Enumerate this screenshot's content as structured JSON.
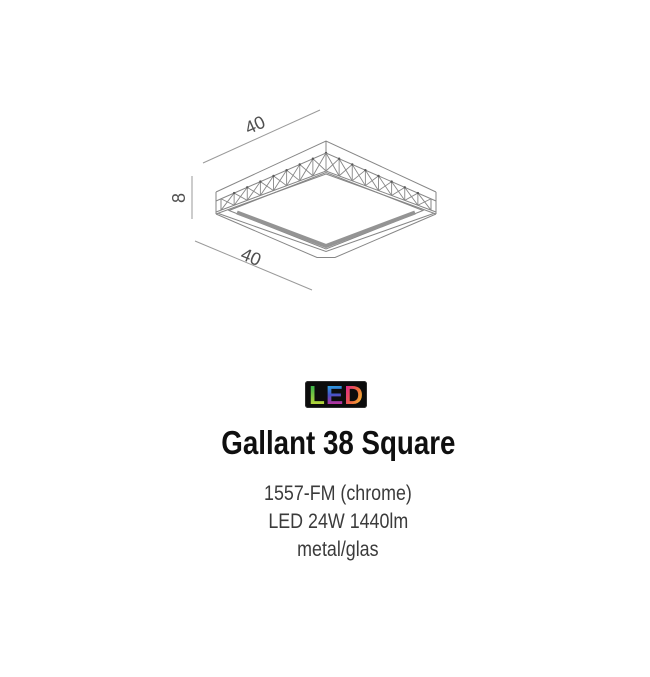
{
  "product": {
    "name": "Gallant 38 Square",
    "code": "1557-FM (chrome)",
    "power": "LED 24W 1440lm",
    "material": "metal/glas"
  },
  "led_logo": {
    "letters": [
      "L",
      "E",
      "D"
    ],
    "background": "#0c0c0c",
    "gradient_colors": [
      "#2fb34c",
      "#c6d938",
      "#27b6e8",
      "#4553c6",
      "#e0258c",
      "#ee6a3c",
      "#f4cf33"
    ]
  },
  "diagram": {
    "width_top": "40",
    "height": "8",
    "width_bottom": "40",
    "line_color": "#868686",
    "label_color": "#4f4f4f"
  }
}
